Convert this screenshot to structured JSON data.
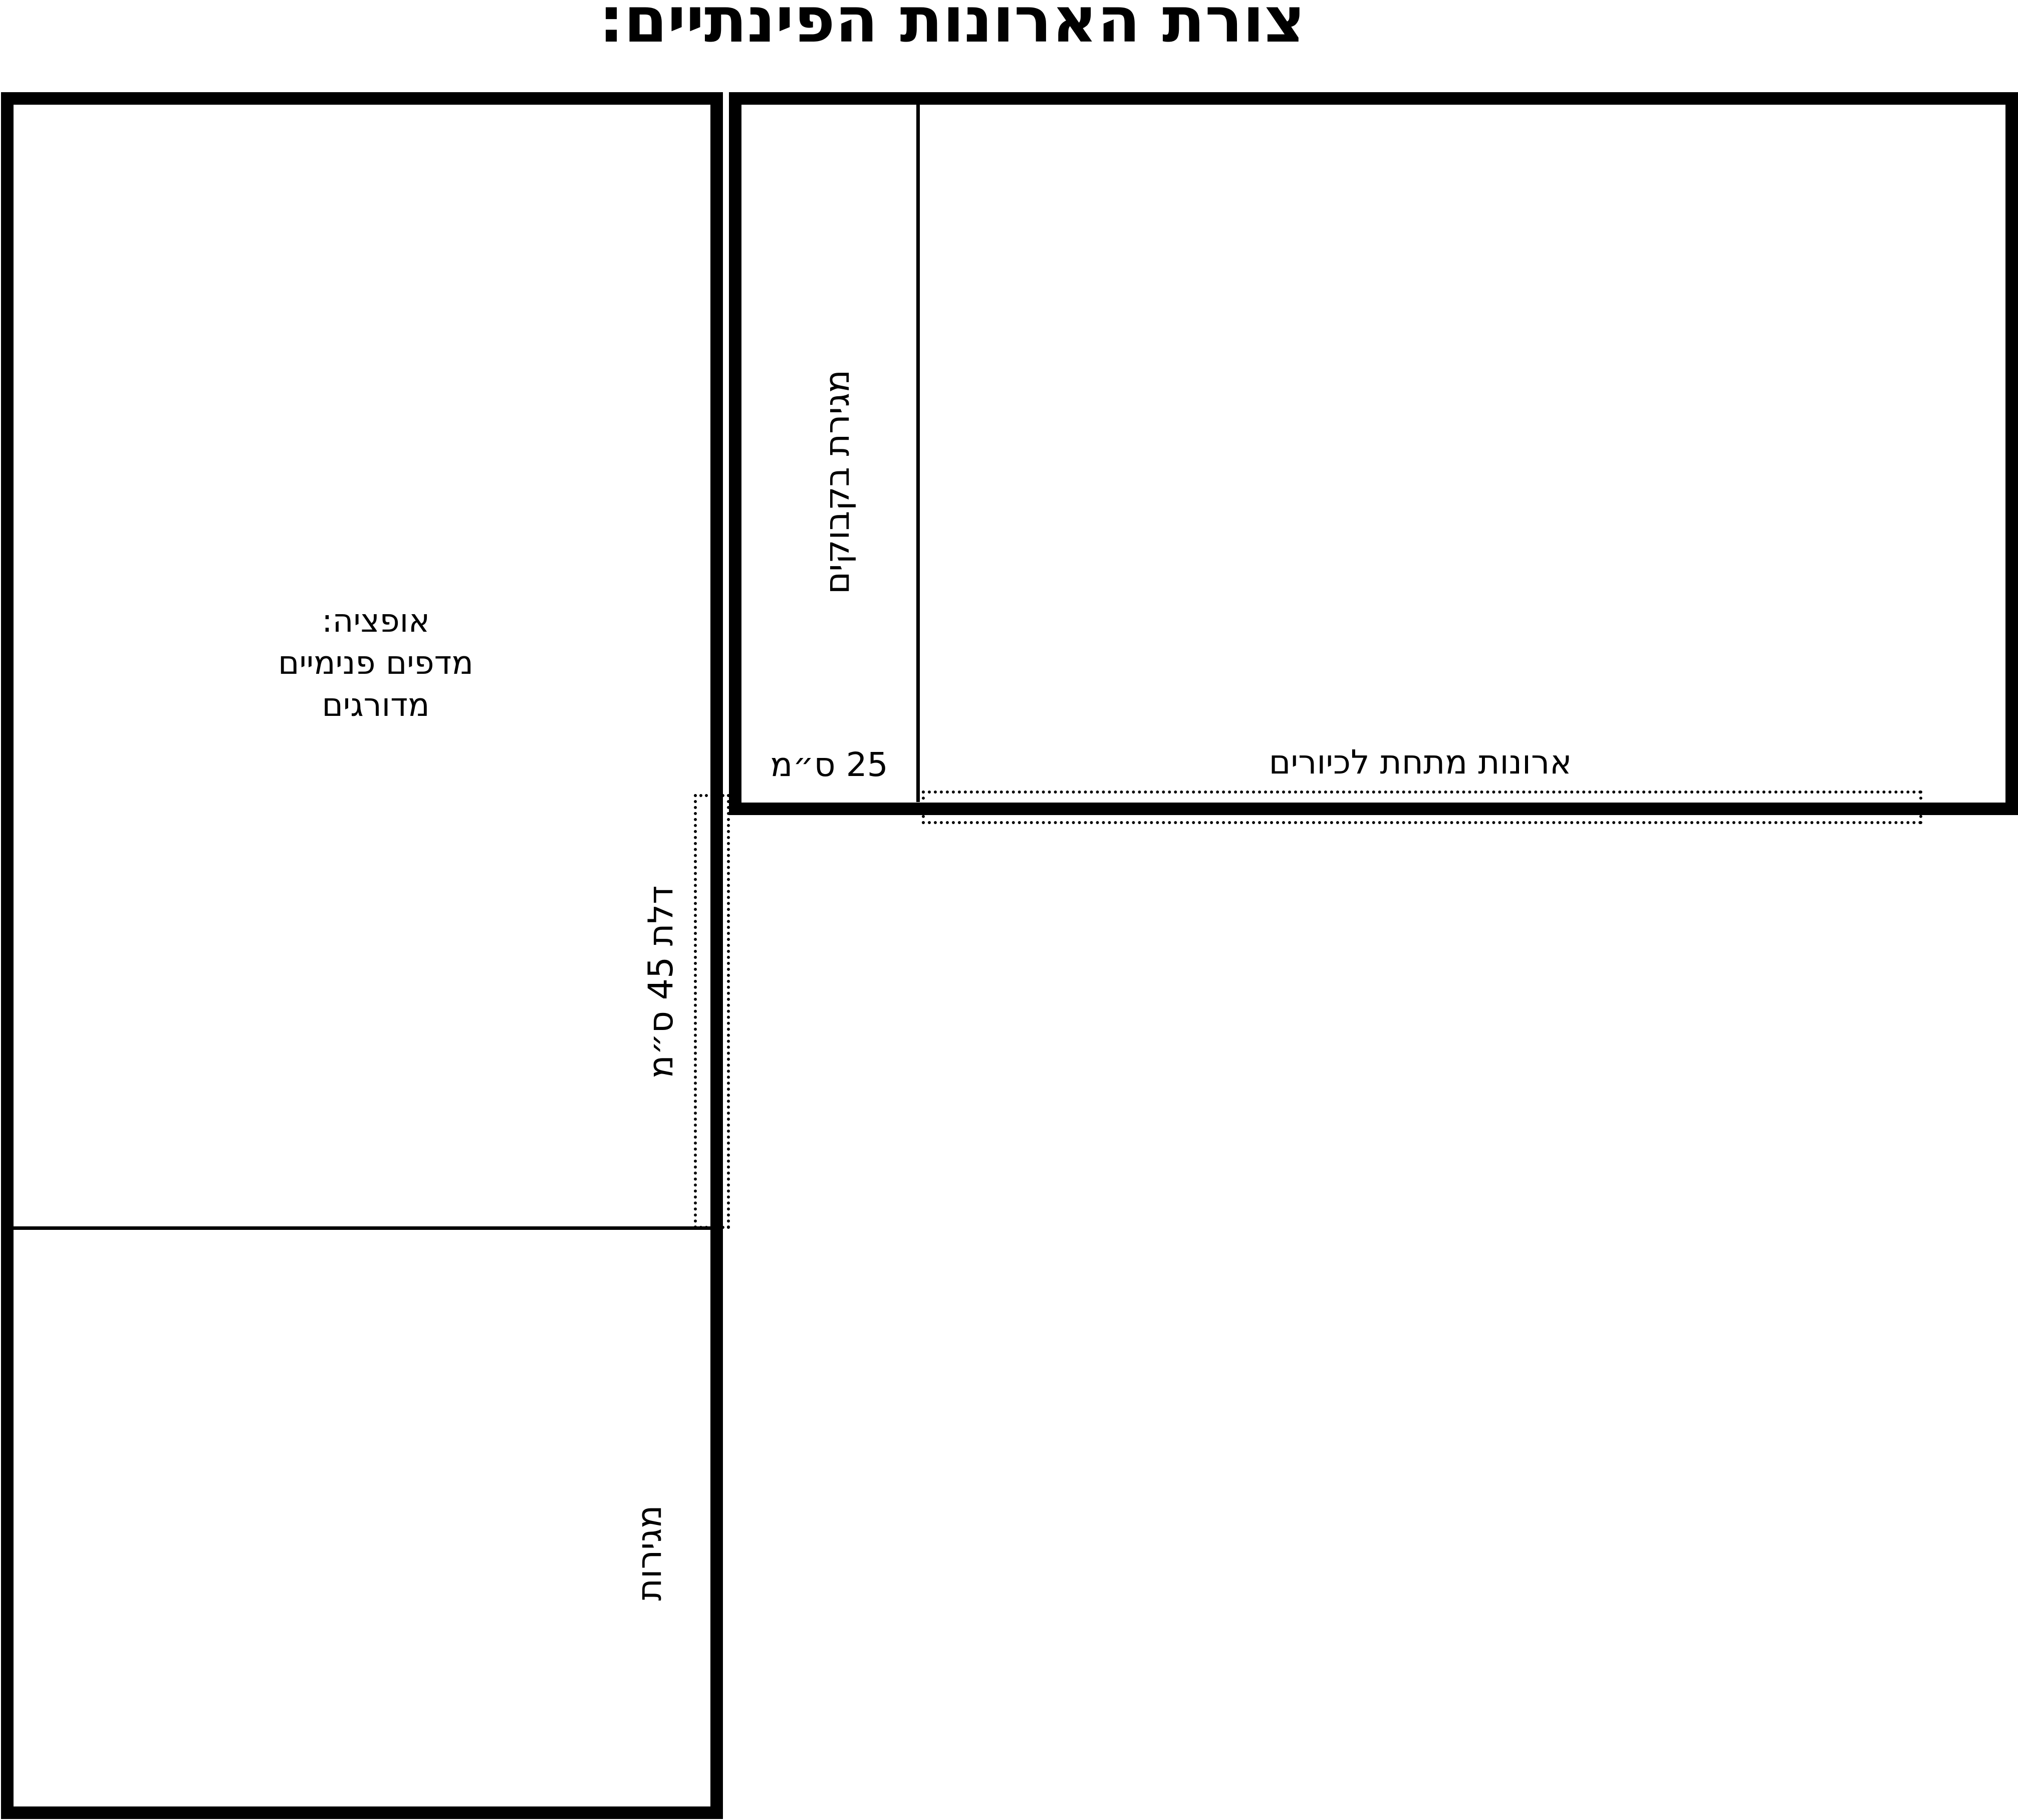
{
  "title": "צורת הארונות הפינתיים:",
  "colors": {
    "line": "#000000",
    "background": "#ffffff"
  },
  "tall_cabinet": {
    "option_note": {
      "line1": "אופציה:",
      "line2": "מדפים פנימיים",
      "line3": "מדורגים"
    },
    "drawers_label": "מגירות",
    "door_label": "דלת 45 ס״מ"
  },
  "base_cabinet": {
    "bottle_drawer_label": "מגירת בקבוקים",
    "width_label": "25 ס״מ",
    "sink_cabinets_label": "ארונות מתחת לכיורים"
  }
}
